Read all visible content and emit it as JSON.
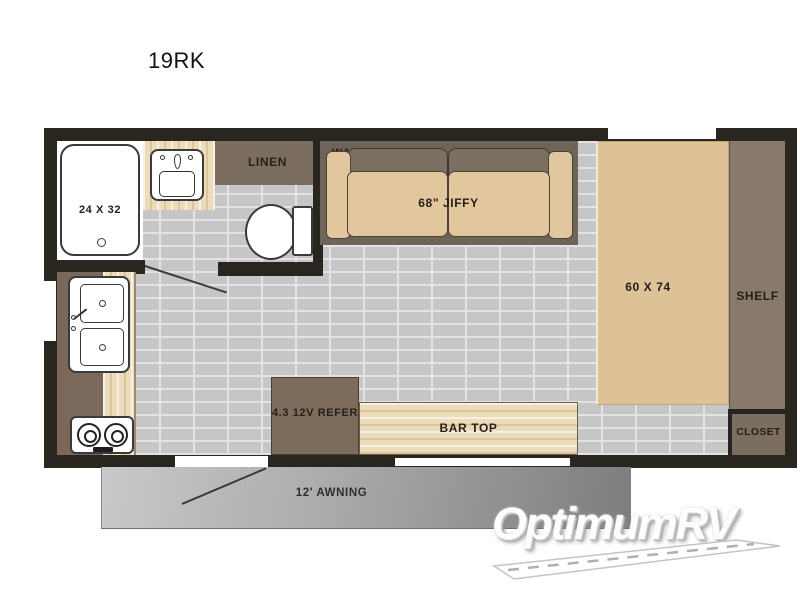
{
  "page": {
    "title": "19RK"
  },
  "floorplan": {
    "bathroom": {
      "shower_label": "24 X 32",
      "linen_label": "LINEN"
    },
    "living_area": {
      "wall_ac_label": "WALL AC",
      "sofa_label": "68\" JIFFY"
    },
    "bedroom": {
      "bed_label": "60 X 74",
      "shelf_label": "SHELF",
      "closet_label": "CLOSET"
    },
    "kitchen": {
      "refrigerator_label": "4.3 12V REFER",
      "bar_top_label": "BAR TOP"
    },
    "exterior": {
      "awning_label": "12' AWNING"
    },
    "fixtures": [
      "shower-pan",
      "bathroom-sink",
      "linen-cabinet",
      "toilet",
      "wall-ac",
      "sofa",
      "bed",
      "shelf",
      "closet",
      "kitchen-sink",
      "stove",
      "refrigerator",
      "bar-top",
      "entry-door",
      "awning"
    ]
  },
  "watermark": {
    "brand": "OptimumRV"
  },
  "colors": {
    "wall": "#29251f",
    "floor_brick": "#c6c6c6",
    "mortar": "#e3e3e3",
    "cabinet_brown": "#7b6e61",
    "cushion_tan": "#e2c69d",
    "bed_tan": "#ddc197",
    "counter_wood": "#ecdcba",
    "awning_gray": "#9a9a9a"
  }
}
